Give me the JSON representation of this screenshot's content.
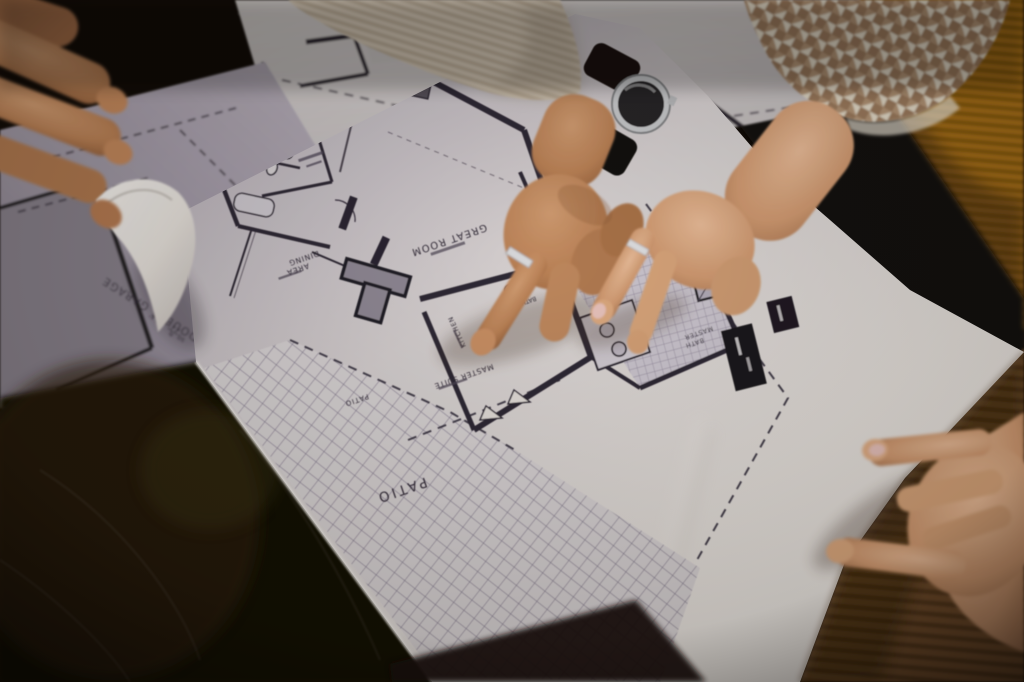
{
  "photo": {
    "labels": {
      "great_room": "GREAT ROOM",
      "dining_line1": "DINING",
      "dining_line2": "AREA",
      "kitchen": "KITCHEN",
      "master_suite": "MASTER SUITE",
      "master_bath_line1": "MASTER",
      "master_bath_line2": "BATH",
      "hall_bath": "BATH",
      "patio_large": "PATIO",
      "patio_small": "PATIO",
      "garage_name": "DOUBLE GARAGE",
      "garage_dims": "22' x 24'",
      "garage_area": "sq. ft.",
      "garage_name_small": "DOUBLE GARAGE"
    },
    "colors": {
      "background_dark": "#0d0906",
      "paper_white": "#f2efec",
      "paper_shadow_lavender": "#b7b2be",
      "plan_line": "#2b2735",
      "hatch_line": "#868096",
      "skin_man": "#c08a63",
      "skin_woman": "#e2b18c",
      "sleeve_beige": "#d2c7b6",
      "houndstooth_cream": "#e7e0cf",
      "houndstooth_brown": "#9c7c5f",
      "pouf_caramel": "#a87017",
      "corduroy_brown": "#6f4c2a",
      "watch_steel": "#cdd0d4",
      "watch_dial": "#222227",
      "nail_pink": "#ecc9c5"
    }
  }
}
